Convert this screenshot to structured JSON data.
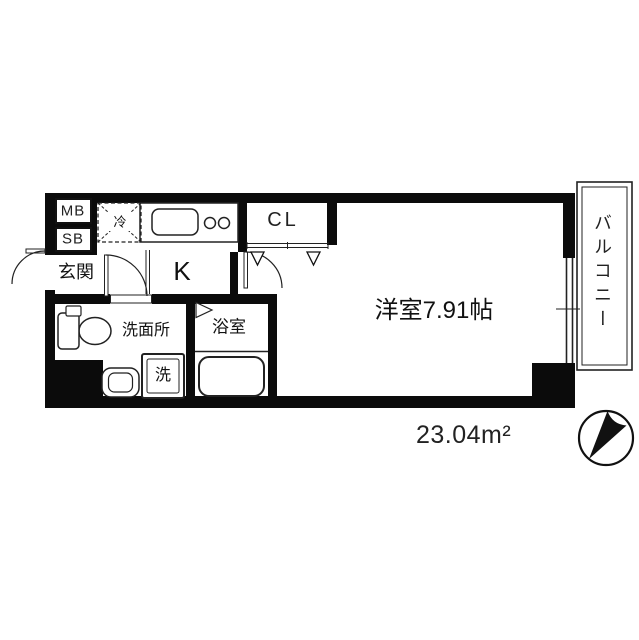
{
  "floorplan": {
    "rooms": {
      "entrance": {
        "label": "玄関"
      },
      "kitchen": {
        "label": "K"
      },
      "closet": {
        "label": "CL"
      },
      "main_room": {
        "label": "洋室7.91帖"
      },
      "washroom": {
        "label": "洗面所"
      },
      "bathroom": {
        "label": "浴室"
      },
      "balcony": {
        "label": "バルコニー"
      }
    },
    "equipment": {
      "meter_box": {
        "label": "MB"
      },
      "shaft_box": {
        "label": "SB"
      },
      "refrigerator_space": {
        "label": "冷"
      },
      "washing_machine_space": {
        "label": "洗"
      }
    },
    "total_area": {
      "label": "23.04m²"
    },
    "colors": {
      "wall": "#0b0b0b",
      "line": "#222222",
      "background": "#ffffff"
    },
    "icons": {
      "compass": "compass-north-icon"
    }
  }
}
